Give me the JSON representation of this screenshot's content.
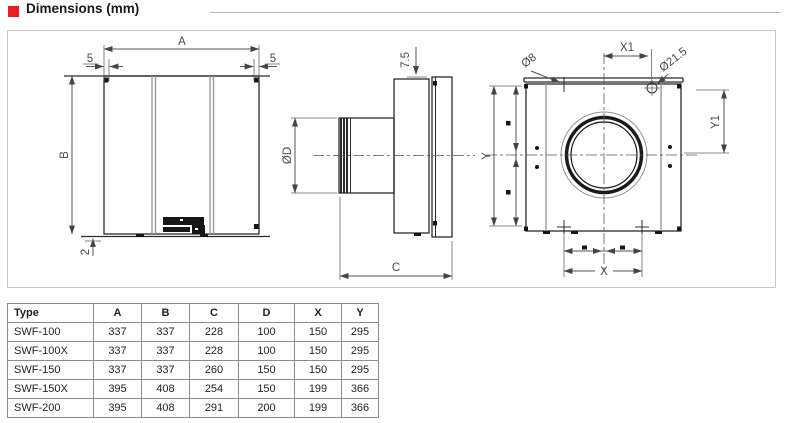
{
  "header": {
    "title": "Dimensions (mm)",
    "accent_color": "#ec1c24"
  },
  "diagram": {
    "front_view": {
      "width_label": "A",
      "height_label": "B",
      "offset_left": "5",
      "offset_right": "5",
      "bottom_offset": "2"
    },
    "side_view": {
      "plate_offset": "7.5",
      "duct_diameter": "ØD",
      "depth_label": "C"
    },
    "back_view": {
      "x1_label": "X1",
      "small_hole": "Ø8",
      "large_hole": "Ø21.5",
      "y_label": "Y",
      "y1_label": "Y1",
      "x_label": "X"
    }
  },
  "table": {
    "columns": [
      "Type",
      "A",
      "B",
      "C",
      "D",
      "X",
      "Y"
    ],
    "rows": [
      [
        "SWF-100",
        "337",
        "337",
        "228",
        "100",
        "150",
        "295"
      ],
      [
        "SWF-100X",
        "337",
        "337",
        "228",
        "100",
        "150",
        "295"
      ],
      [
        "SWF-150",
        "337",
        "337",
        "260",
        "150",
        "150",
        "295"
      ],
      [
        "SWF-150X",
        "395",
        "408",
        "254",
        "150",
        "199",
        "366"
      ],
      [
        "SWF-200",
        "395",
        "408",
        "291",
        "200",
        "199",
        "366"
      ]
    ]
  }
}
